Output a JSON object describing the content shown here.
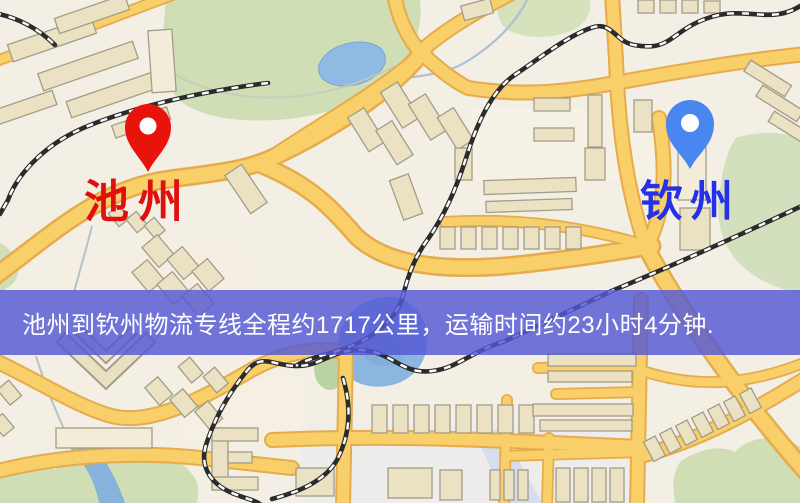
{
  "map": {
    "origin": {
      "label": "池州",
      "pin_color": "#e8130a",
      "label_color": "#e01010"
    },
    "destination": {
      "label": "钦州",
      "pin_color": "#4a86f0",
      "label_color": "#2531e8"
    },
    "banner": {
      "text": "池州到钦州物流专线全程约1717公里，运输时间约23小时4分钟.",
      "distance_text": "约1717公里",
      "duration_text": "约23小时4分钟",
      "bg_color": "#5458d4",
      "text_color": "#ffffff"
    },
    "style_colors": {
      "background": "#f3efe4",
      "road_fill": "#f8cf68",
      "road_casing": "#e5ac4d",
      "building_fill": "#ebe2c4",
      "park_green": "#cfdeb4",
      "water_blue": "#8cb6e0",
      "railway_black": "#2b2b2b"
    }
  }
}
